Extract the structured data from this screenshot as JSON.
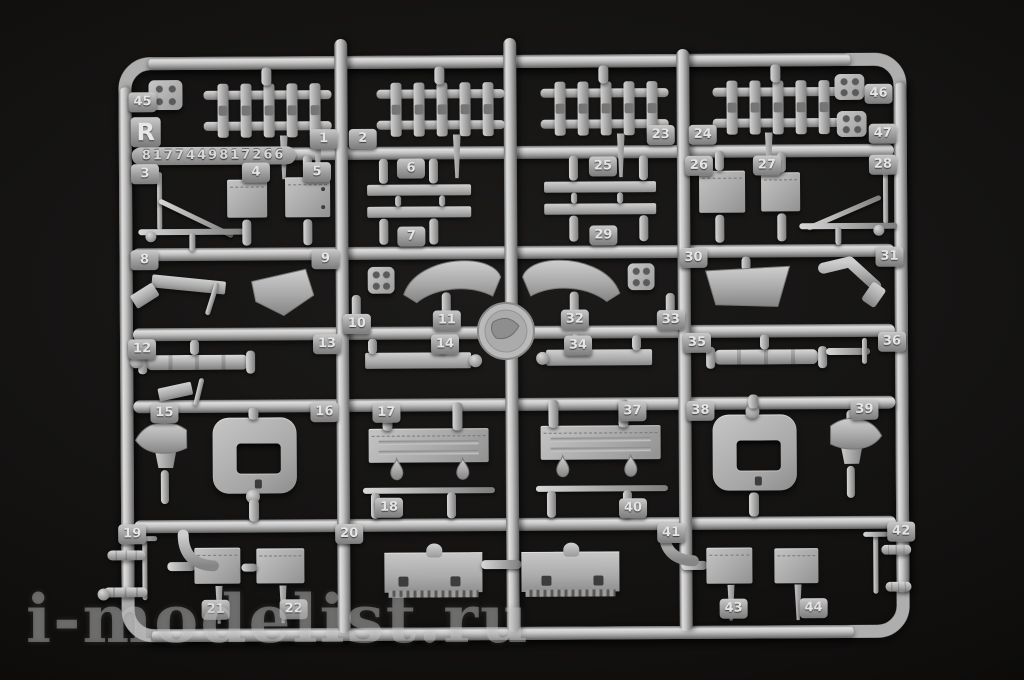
{
  "scene": {
    "description": "Photograph of grey injection-molded model kit sprue (runner R) on a black background",
    "watermark": "i-modelist.ru"
  },
  "sprue": {
    "gate_letter": "R",
    "part_code": "8177449817266",
    "colors": {
      "plastic": "#b2b2b2",
      "plastic_highlight": "#e0e0e0",
      "plastic_shadow": "#6f6f6f",
      "background": "#100f0e",
      "watermark": "#cdcdcd"
    },
    "tags": [
      {
        "label": "45",
        "x": 130,
        "y": 90
      },
      {
        "label": "46",
        "x": 866,
        "y": 86
      },
      {
        "label": "47",
        "x": 870,
        "y": 126
      },
      {
        "label": "1",
        "x": 311,
        "y": 128
      },
      {
        "label": "2",
        "x": 350,
        "y": 128
      },
      {
        "label": "23",
        "x": 648,
        "y": 126
      },
      {
        "label": "24",
        "x": 690,
        "y": 126
      },
      {
        "label": "3",
        "x": 132,
        "y": 162
      },
      {
        "label": "4",
        "x": 243,
        "y": 161
      },
      {
        "label": "5",
        "x": 304,
        "y": 161
      },
      {
        "label": "6",
        "x": 398,
        "y": 158
      },
      {
        "label": "25",
        "x": 590,
        "y": 157
      },
      {
        "label": "26",
        "x": 686,
        "y": 157
      },
      {
        "label": "27",
        "x": 754,
        "y": 157
      },
      {
        "label": "28",
        "x": 870,
        "y": 157
      },
      {
        "label": "7",
        "x": 398,
        "y": 226
      },
      {
        "label": "29",
        "x": 590,
        "y": 226
      },
      {
        "label": "8",
        "x": 131,
        "y": 248
      },
      {
        "label": "9",
        "x": 312,
        "y": 248
      },
      {
        "label": "30",
        "x": 680,
        "y": 249
      },
      {
        "label": "31",
        "x": 876,
        "y": 249
      },
      {
        "label": "10",
        "x": 343,
        "y": 313
      },
      {
        "label": "11",
        "x": 433,
        "y": 310
      },
      {
        "label": "32",
        "x": 561,
        "y": 310
      },
      {
        "label": "33",
        "x": 657,
        "y": 311
      },
      {
        "label": "12",
        "x": 128,
        "y": 337
      },
      {
        "label": "13",
        "x": 313,
        "y": 333
      },
      {
        "label": "14",
        "x": 431,
        "y": 334
      },
      {
        "label": "34",
        "x": 564,
        "y": 336
      },
      {
        "label": "35",
        "x": 683,
        "y": 334
      },
      {
        "label": "36",
        "x": 878,
        "y": 334
      },
      {
        "label": "15",
        "x": 150,
        "y": 401
      },
      {
        "label": "16",
        "x": 310,
        "y": 401
      },
      {
        "label": "17",
        "x": 372,
        "y": 402
      },
      {
        "label": "37",
        "x": 618,
        "y": 402
      },
      {
        "label": "38",
        "x": 686,
        "y": 402
      },
      {
        "label": "39",
        "x": 850,
        "y": 402
      },
      {
        "label": "18",
        "x": 374,
        "y": 497
      },
      {
        "label": "40",
        "x": 618,
        "y": 499
      },
      {
        "label": "19",
        "x": 117,
        "y": 522
      },
      {
        "label": "20",
        "x": 334,
        "y": 523
      },
      {
        "label": "41",
        "x": 656,
        "y": 524
      },
      {
        "label": "42",
        "x": 886,
        "y": 524
      },
      {
        "label": "21",
        "x": 200,
        "y": 598
      },
      {
        "label": "22",
        "x": 278,
        "y": 598
      },
      {
        "label": "43",
        "x": 718,
        "y": 600
      },
      {
        "label": "44",
        "x": 798,
        "y": 600
      }
    ]
  }
}
